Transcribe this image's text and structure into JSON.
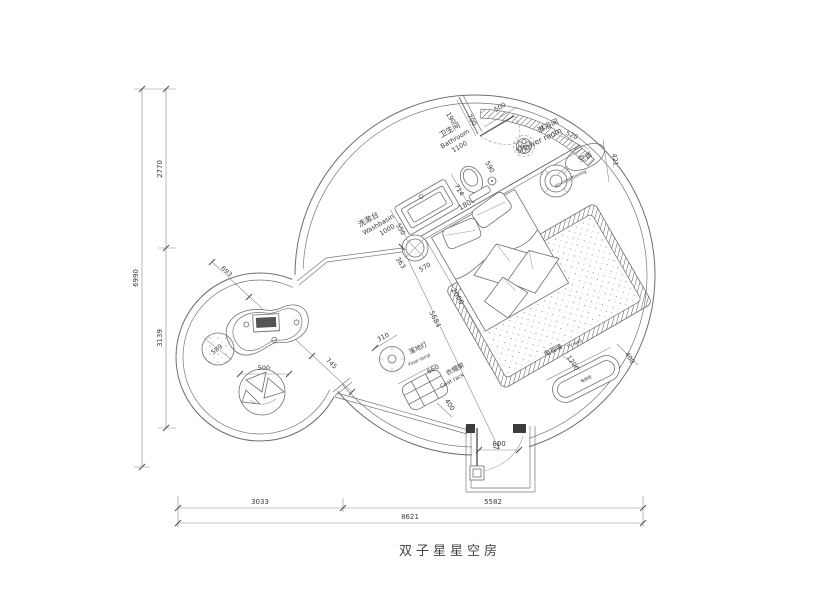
{
  "title": "双子星星空房",
  "colors": {
    "line": "#6f6f6f",
    "dark": "#3c3c3c",
    "text": "#3a3a3a",
    "bg": "#ffffff"
  },
  "dims": {
    "d6990": "6990",
    "d2770": "2770",
    "d3139": "3139",
    "d3033": "3033",
    "d5582": "5582",
    "d8621": "8621",
    "d190": "190",
    "d700": "700",
    "d500_shower": "500",
    "d590": "590",
    "d1100": "1100",
    "d714": "714",
    "d1000": "1000",
    "d550": "550",
    "d520": "520",
    "d421": "421",
    "d1800": "1800",
    "d2000": "2000",
    "d570": "570",
    "d363": "363",
    "d5684": "5684",
    "d310": "310",
    "d660": "660",
    "d400_coat": "400",
    "d1200": "1200",
    "d400_tv": "400",
    "d800": "800",
    "d693": "693",
    "d1166": "1166",
    "d745": "745",
    "d589": "589",
    "d500_beanbag": "500"
  },
  "labels": {
    "washbasin_cn": "洗漱台",
    "washbasin_en": "Washbasin",
    "bathroom_cn": "卫生间",
    "bathroom_en": "Bathroom",
    "shower_cn": "淋浴间",
    "shower_en": "Shower room",
    "ac_cn": "空调",
    "ac_en": "air-conditioning",
    "floorlamp_cn": "落地灯",
    "floorlamp_en": "Floor lamp",
    "coatrack_cn": "衣帽架",
    "coatrack_en": "Coat rack",
    "tvwall_cn": "电视墙",
    "tvwall_en": "TV wall",
    "tvcabinet": "电视柜"
  }
}
